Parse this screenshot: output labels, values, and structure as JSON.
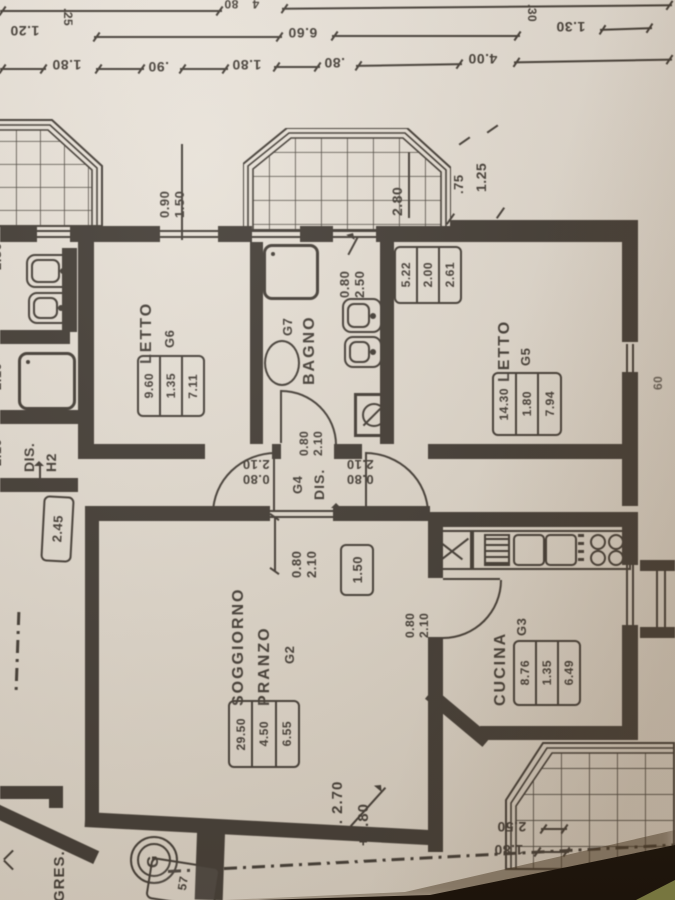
{
  "colors": {
    "ink": "#3e3831",
    "paper": "#e2dbd0",
    "shadow": "#241a10",
    "accent_olive": "#77763f"
  },
  "dims_top": {
    "row1": [
      "80",
      "4"
    ],
    "row2": [
      "1.20",
      ".25",
      "6.60",
      ".30",
      "1.30"
    ],
    "row3": [
      "1.80",
      ".90",
      "1.80",
      ".80",
      "4.00"
    ]
  },
  "upper": {
    "g6_window": [
      "0.90",
      "1.50"
    ],
    "balcony_depth": "2.80",
    "corner_a": ".75",
    "corner_b": "1.25"
  },
  "edge": {
    "left": [
      "2.50",
      "2.10",
      "2.10"
    ],
    "right_window": "60"
  },
  "letto_g6": {
    "label": "LETTO",
    "code": "G6",
    "table": [
      "9.60",
      "1.35",
      "7.11"
    ]
  },
  "bagno": {
    "label": "BAGNO",
    "code": "G7",
    "window": [
      "0.80",
      "2.50"
    ],
    "door": [
      "0.80",
      "2.10"
    ]
  },
  "letto_g5": {
    "label": "LETTO",
    "code": "G5",
    "table": [
      "14.30",
      "1.80",
      "7.94"
    ],
    "table2": [
      "5.22",
      "2.00",
      "2.61"
    ]
  },
  "dis_g4": {
    "label": "DIS.",
    "code": "G4",
    "door_left": [
      "0.80",
      "2.10"
    ],
    "door_right": [
      "0.80",
      "2.10"
    ],
    "pass": [
      "0.80",
      "2.10"
    ],
    "cell": "1.50"
  },
  "soggiorno": {
    "label1": "SOGGIORNO",
    "label2": "PRANZO",
    "code": "G2",
    "table": [
      "29.50",
      "4.50",
      "6.55"
    ],
    "height": "H. 2.70",
    "elevation": "+2.80"
  },
  "cucina": {
    "label": "CUCINA",
    "code": "G3",
    "table": [
      "8.76",
      "1.35",
      "6.49"
    ],
    "door": [
      "0.80",
      "2.10"
    ]
  },
  "dis_h2": {
    "label": "DIS.",
    "code": "H2",
    "cell": "2.45"
  },
  "terrace": {
    "d1": "2.50",
    "d2": "1.80"
  },
  "ingresso": {
    "label": "GRES.",
    "unit_marker": "G",
    "cell": "57"
  }
}
